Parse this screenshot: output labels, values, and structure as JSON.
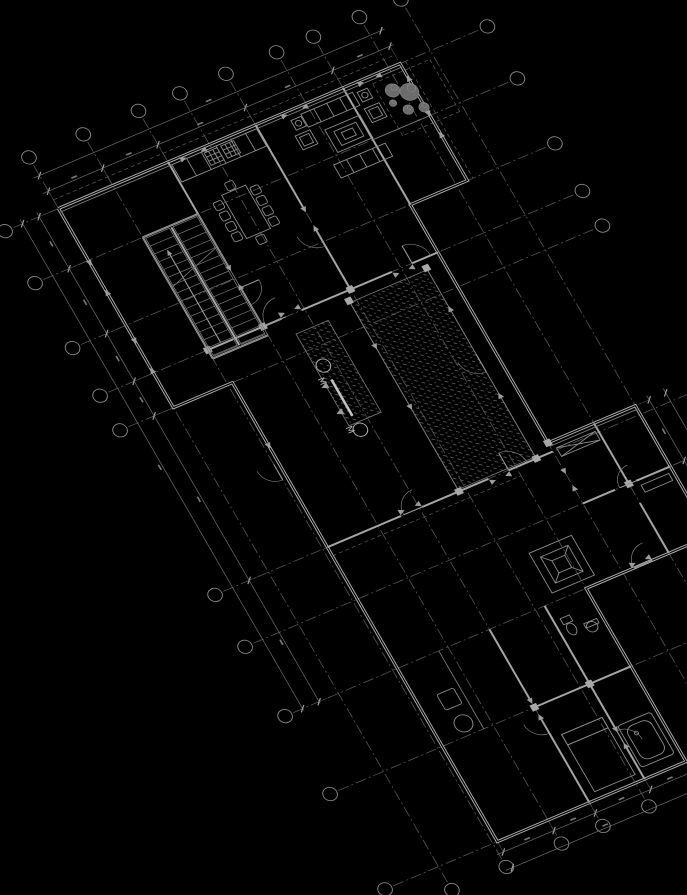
{
  "meta": {
    "description": "Rotated architectural CAD floor plan viewport on black background"
  },
  "palette": {
    "background": "#000000",
    "wall_bright": "#b4b4b4",
    "wall": "#a6a6a6",
    "line": "#7e7e7e",
    "axis": "#565656",
    "hatch": "#5d5d5d",
    "marker": "#c2c2c2"
  },
  "view": {
    "matrix": [
      0.9205,
      -0.3907,
      0.5,
      0.866,
      168,
      162
    ]
  },
  "section_marker": {
    "label": "М"
  },
  "plan": {
    "outline": [
      [
        -119,
        0
      ],
      [
        252,
        0
      ],
      [
        252,
        135
      ],
      [
        190,
        135
      ],
      [
        190,
        410
      ],
      [
        285,
        410
      ],
      [
        285,
        560
      ],
      [
        150,
        560
      ],
      [
        150,
        760
      ],
      [
        -55,
        760
      ],
      [
        -55,
        230
      ],
      [
        -119,
        230
      ],
      [
        -119,
        0
      ]
    ],
    "walls_heavy": [
      [
        [
          -60,
          190
        ],
        [
          20,
          190
        ]
      ],
      [
        [
          42,
          190
        ],
        [
          140,
          190
        ]
      ],
      [
        [
          162,
          190
        ],
        [
          190,
          190
        ]
      ],
      [
        [
          -55,
          420
        ],
        [
          25,
          420
        ]
      ],
      [
        [
          48,
          420
        ],
        [
          120,
          420
        ]
      ],
      [
        [
          142,
          420
        ],
        [
          190,
          420
        ]
      ],
      [
        [
          240,
          410
        ],
        [
          240,
          480
        ]
      ],
      [
        [
          240,
          502
        ],
        [
          240,
          560
        ]
      ],
      [
        [
          190,
          480
        ],
        [
          225,
          480
        ]
      ],
      [
        [
          248,
          480
        ],
        [
          285,
          480
        ]
      ],
      [
        [
          0,
          0
        ],
        [
          0,
          120
        ]
      ],
      [
        [
          0,
          145
        ],
        [
          0,
          190
        ]
      ],
      [
        [
          95,
          0
        ],
        [
          95,
          95
        ]
      ],
      [
        [
          95,
          120
        ],
        [
          95,
          190
        ]
      ],
      [
        [
          -60,
          60
        ],
        [
          0,
          60
        ]
      ],
      [
        [
          -60,
          200
        ],
        [
          0,
          200
        ]
      ],
      [
        [
          -60,
          60
        ],
        [
          -60,
          200
        ]
      ],
      [
        [
          190,
          0
        ],
        [
          190,
          135
        ]
      ],
      [
        [
          45,
          560
        ],
        [
          45,
          640
        ]
      ],
      [
        [
          45,
          662
        ],
        [
          45,
          760
        ]
      ],
      [
        [
          105,
          560
        ],
        [
          105,
          700
        ]
      ],
      [
        [
          105,
          722
        ],
        [
          105,
          760
        ]
      ],
      [
        [
          45,
          650
        ],
        [
          150,
          650
        ]
      ]
    ],
    "walls_light": [
      [
        [
          88,
          200
        ],
        [
          88,
          420
        ]
      ],
      [
        [
          172,
          200
        ],
        [
          172,
          420
        ]
      ],
      [
        [
          -10,
          560
        ],
        [
          -10,
          650
        ]
      ],
      [
        [
          190,
          60
        ],
        [
          252,
          60
        ]
      ],
      [
        [
          -119,
          4
        ],
        [
          252,
          4
        ]
      ],
      [
        [
          190,
          414
        ],
        [
          285,
          414
        ]
      ]
    ],
    "dashes": [
      [
        [
          -119,
          -10
        ],
        [
          252,
          -10
        ]
      ],
      [
        [
          258,
          0
        ],
        [
          258,
          135
        ]
      ],
      [
        [
          218,
          8
        ],
        [
          280,
          8
        ]
      ],
      [
        [
          280,
          8
        ],
        [
          280,
          68
        ]
      ],
      [
        [
          280,
          68
        ],
        [
          218,
          68
        ]
      ],
      [
        [
          218,
          68
        ],
        [
          218,
          8
        ]
      ],
      [
        [
          -55,
          430
        ],
        [
          150,
          430
        ]
      ]
    ],
    "hatches": [
      {
        "x": 88,
        "y": 202,
        "w": 84,
        "h": 216
      },
      {
        "x": 25,
        "y": 210,
        "w": 35,
        "h": 106
      }
    ],
    "axes": {
      "u_lines": [
        -119,
        -60,
        0,
        45,
        95,
        150,
        190,
        240,
        285
      ],
      "v_lines": [
        0,
        60,
        135,
        190,
        230,
        420,
        480,
        560,
        650,
        760
      ],
      "v_range": [
        -50,
        778
      ],
      "u_range": [
        -168,
        338
      ],
      "bubble_r": 7
    },
    "dims": [
      {
        "dir": "h",
        "at": -20,
        "from": -125,
        "to": 256,
        "ticks": [
          -119,
          -60,
          0,
          95,
          190,
          252
        ],
        "ext": 16
      },
      {
        "dir": "h",
        "at": -38,
        "from": -125,
        "to": 256,
        "ticks": [
          -119,
          252
        ],
        "ext": 0
      },
      {
        "dir": "v",
        "at": -140,
        "from": -5,
        "to": 562,
        "ticks": [
          0,
          60,
          135,
          190,
          230,
          420,
          560
        ],
        "ext": 14
      },
      {
        "dir": "v",
        "at": -158,
        "from": -5,
        "to": 562,
        "ticks": [
          0,
          560
        ],
        "ext": 0
      },
      {
        "dir": "h",
        "at": 772,
        "from": -62,
        "to": 156,
        "ticks": [
          -55,
          0,
          45,
          105,
          150
        ],
        "ext": 14
      },
      {
        "dir": "h",
        "at": 790,
        "from": -62,
        "to": 156,
        "ticks": [
          -55,
          150
        ],
        "ext": 0
      },
      {
        "dir": "v",
        "at": 300,
        "from": 405,
        "to": 565,
        "ticks": [
          410,
          480,
          560
        ],
        "ext": 12
      },
      {
        "dir": "v",
        "at": 318,
        "from": 405,
        "to": 565,
        "ticks": [
          410,
          560
        ],
        "ext": 0
      }
    ],
    "stair": {
      "frame": [
        -60,
        60,
        60,
        140
      ],
      "flights": [
        [
          -58,
          62,
          26,
          136
        ],
        [
          -28,
          62,
          26,
          136
        ]
      ],
      "mid": [
        [
          -30,
          62
        ],
        [
          -30,
          198
        ]
      ],
      "tread_step": 9,
      "arrow": [
        [
          -45,
          188
        ],
        [
          -45,
          82
        ]
      ],
      "break": [
        [
          -60,
          118
        ],
        [
          0,
          98
        ]
      ]
    },
    "doors": [
      {
        "h": [
          25,
          190
        ],
        "r": 22,
        "a0": 180,
        "a1": 270
      },
      {
        "h": [
          162,
          190
        ],
        "r": 20,
        "a0": 270,
        "a1": 360
      },
      {
        "h": [
          48,
          420
        ],
        "r": 20,
        "a0": 180,
        "a1": 270
      },
      {
        "h": [
          142,
          420
        ],
        "r": 20,
        "a0": 270,
        "a1": 360
      },
      {
        "h": [
          248,
          480
        ],
        "r": 18,
        "a0": 180,
        "a1": 270
      },
      {
        "h": [
          222,
          560
        ],
        "r": 20,
        "a0": 180,
        "a1": 270
      },
      {
        "h": [
          45,
          662
        ],
        "r": 18,
        "a0": 90,
        "a1": 180
      },
      {
        "h": [
          105,
          722
        ],
        "r": 18,
        "a0": 270,
        "a1": 360
      },
      {
        "h": [
          0,
          145
        ],
        "r": 20,
        "a0": 0,
        "a1": 90
      },
      {
        "h": [
          95,
          120
        ],
        "r": 20,
        "a0": 90,
        "a1": 180
      },
      {
        "h": [
          -60,
          322
        ],
        "r": 18,
        "a0": 90,
        "a1": 180
      },
      {
        "h": [
          172,
          300
        ],
        "r": 20,
        "a0": 90,
        "a1": 180
      }
    ],
    "triangles": [
      [
        40,
        3,
        180
      ],
      [
        12,
        3,
        0
      ],
      [
        150,
        3,
        180
      ],
      [
        122,
        3,
        0
      ],
      [
        230,
        3,
        180
      ],
      [
        205,
        3,
        0
      ],
      [
        252,
        55,
        90
      ],
      [
        252,
        85,
        270
      ],
      [
        -119,
        60,
        90
      ],
      [
        -119,
        100,
        270
      ],
      [
        -119,
        150,
        90
      ],
      [
        -119,
        190,
        270
      ],
      [
        20,
        186,
        0
      ],
      [
        42,
        186,
        180
      ],
      [
        140,
        194,
        0
      ],
      [
        162,
        194,
        180
      ],
      [
        25,
        416,
        0
      ],
      [
        48,
        416,
        180
      ],
      [
        120,
        424,
        0
      ],
      [
        142,
        424,
        180
      ],
      [
        190,
        440,
        90
      ],
      [
        190,
        465,
        270
      ],
      [
        200,
        556,
        0
      ],
      [
        222,
        556,
        180
      ],
      [
        45,
        640,
        90
      ],
      [
        45,
        664,
        270
      ],
      [
        105,
        700,
        90
      ],
      [
        105,
        724,
        270
      ],
      [
        0,
        120,
        90
      ],
      [
        0,
        147,
        270
      ],
      [
        95,
        95,
        90
      ],
      [
        95,
        122,
        270
      ],
      [
        88,
        250,
        90
      ],
      [
        88,
        320,
        90
      ],
      [
        172,
        250,
        270
      ],
      [
        172,
        350,
        270
      ],
      [
        -55,
        300,
        90
      ],
      [
        252,
        20,
        270
      ]
    ],
    "columns": [
      [
        88,
        200
      ],
      [
        172,
        200
      ],
      [
        88,
        420
      ],
      [
        172,
        420
      ],
      [
        -60,
        190
      ],
      [
        0,
        190
      ],
      [
        95,
        190
      ],
      [
        190,
        410
      ],
      [
        240,
        480
      ],
      [
        45,
        650
      ],
      [
        105,
        650
      ]
    ],
    "trees": [
      [
        232,
        22,
        7
      ],
      [
        246,
        30,
        9
      ],
      [
        236,
        46,
        5
      ],
      [
        251,
        50,
        5
      ],
      [
        226,
        34,
        3.5
      ]
    ],
    "furniture": {
      "rects": [
        [
          2,
          4,
          92,
          20,
          0
        ],
        [
          30,
          52,
          26,
          50,
          0
        ],
        [
          18,
          56,
          9,
          9,
          2
        ],
        [
          18,
          68,
          9,
          9,
          2
        ],
        [
          18,
          80,
          9,
          9,
          2
        ],
        [
          18,
          92,
          9,
          9,
          2
        ],
        [
          58,
          56,
          9,
          9,
          2
        ],
        [
          58,
          68,
          9,
          9,
          2
        ],
        [
          58,
          80,
          9,
          9,
          2
        ],
        [
          58,
          92,
          9,
          9,
          2
        ],
        [
          38,
          42,
          9,
          9,
          2
        ],
        [
          38,
          104,
          9,
          9,
          2
        ],
        [
          140,
          8,
          56,
          15,
          0
        ],
        [
          143,
          68,
          56,
          15,
          0
        ],
        [
          153,
          32,
          38,
          26,
          0
        ],
        [
          160,
          37,
          24,
          16,
          0
        ],
        [
          166,
          41,
          12,
          8,
          0
        ],
        [
          124,
          26,
          16,
          16,
          0
        ],
        [
          127,
          29,
          10,
          10,
          0
        ],
        [
          198,
          28,
          16,
          16,
          0
        ],
        [
          201,
          31,
          10,
          10,
          0
        ],
        [
          128,
          10,
          11,
          11,
          0
        ],
        [
          200,
          10,
          11,
          11,
          0
        ],
        [
          118,
          505,
          46,
          46,
          0
        ],
        [
          126,
          513,
          30,
          30,
          0
        ],
        [
          134,
          521,
          14,
          14,
          0
        ],
        [
          112,
          578,
          10,
          7,
          0
        ],
        [
          130,
          592,
          14,
          5,
          0
        ],
        [
          108,
          700,
          36,
          48,
          3
        ],
        [
          113,
          705,
          26,
          38,
          8
        ],
        [
          195,
          418,
          42,
          10,
          0
        ],
        [
          250,
          486,
          30,
          8,
          0
        ],
        [
          55,
          686,
          44,
          66,
          0
        ],
        [
          55,
          686,
          44,
          12,
          0
        ],
        [
          -34,
          600,
          18,
          18,
          2
        ]
      ],
      "circles": [
        [
          133.5,
          15.5,
          3
        ],
        [
          205.5,
          15.5,
          3
        ],
        [
          136,
          598,
          5.5
        ],
        [
          121,
          714,
          2
        ],
        [
          -25,
          637,
          9
        ]
      ],
      "ellipses": [
        [
          117,
          592,
          4.5,
          6.5
        ]
      ],
      "lines": [
        [
          154,
          8,
          154,
          23
        ],
        [
          168,
          8,
          168,
          23
        ],
        [
          182,
          8,
          182,
          23
        ],
        [
          157,
          68,
          157,
          83
        ],
        [
          171,
          68,
          171,
          83
        ],
        [
          185,
          68,
          185,
          83
        ],
        [
          18,
          4,
          18,
          24
        ],
        [
          34,
          4,
          34,
          24
        ],
        [
          50,
          4,
          50,
          24
        ],
        [
          66,
          4,
          66,
          24
        ],
        [
          82,
          4,
          82,
          24
        ],
        [
          126,
          513,
          134,
          521
        ],
        [
          156,
          513,
          148,
          521
        ],
        [
          126,
          543,
          134,
          535
        ],
        [
          156,
          543,
          148,
          535
        ],
        [
          55,
          698,
          99,
          698
        ],
        [
          195,
          418,
          237,
          428
        ],
        [
          195,
          428,
          237,
          418
        ]
      ],
      "grids": [
        [
          36,
          6,
          14
        ],
        [
          54,
          6,
          14
        ]
      ]
    },
    "section": {
      "line": [
        [
          33,
          266
        ],
        [
          33,
          308
        ]
      ],
      "circles": [
        [
          33,
          250
        ],
        [
          33,
          324
        ]
      ],
      "r": 7,
      "letters": [
        [
          21,
          260
        ],
        [
          21,
          316
        ]
      ],
      "arrows": [
        [
          27,
          270,
          180
        ],
        [
          27,
          300,
          180
        ]
      ]
    }
  }
}
